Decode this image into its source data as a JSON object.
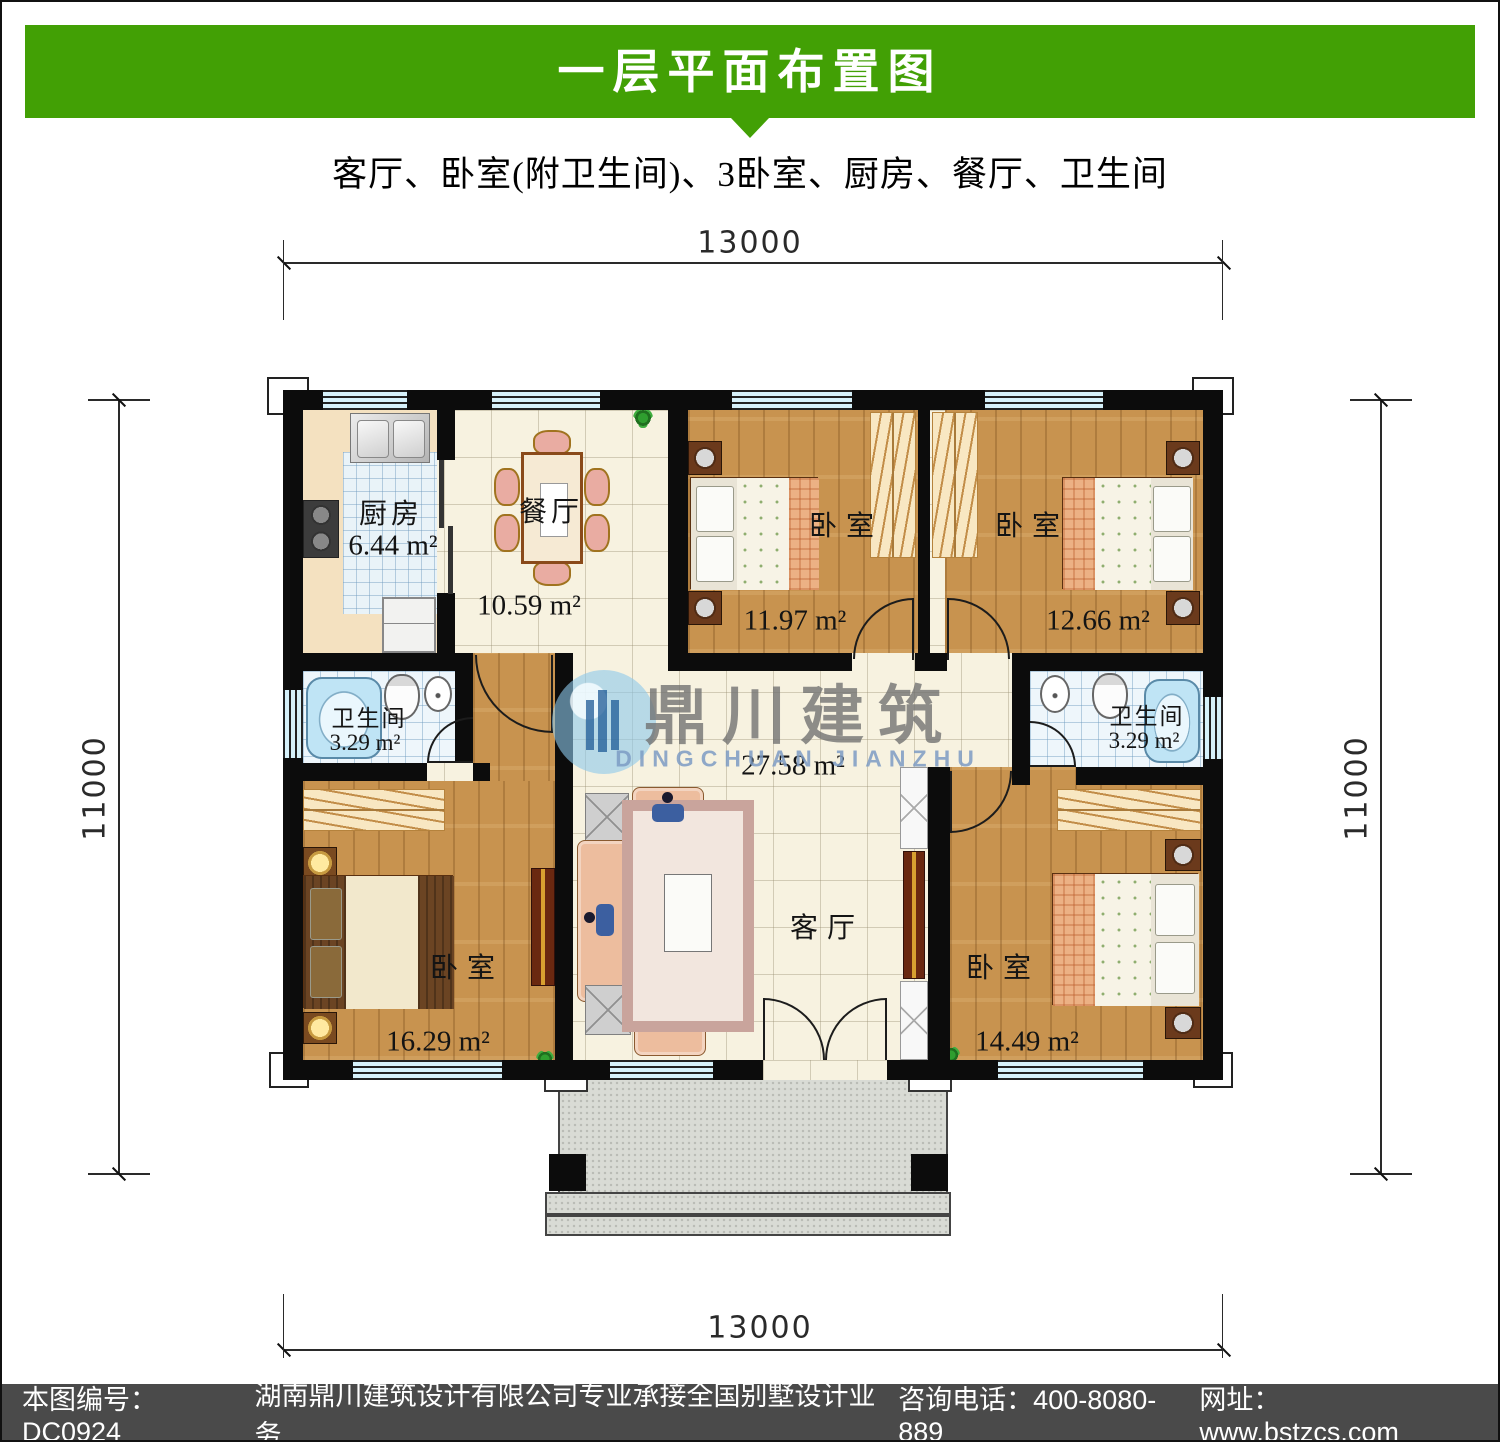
{
  "header": {
    "title": "一层平面布置图",
    "subtitle": "客厅、卧室(附卫生间)、3卧室、厨房、餐厅、卫生间"
  },
  "dimensions": {
    "top": "13000",
    "bottom": "13000",
    "left": "11000",
    "right": "11000"
  },
  "rooms": {
    "kitchen": {
      "name": "厨房",
      "area": "6.44 m²"
    },
    "dining": {
      "name": "餐厅",
      "area": "10.59 m²"
    },
    "bedroom_top_left": {
      "name": "卧室",
      "area": "11.97 m²"
    },
    "bedroom_top_right": {
      "name": "卧室",
      "area": "12.66 m²"
    },
    "bathroom_left": {
      "name": "卫生间",
      "area": "3.29 m²"
    },
    "bathroom_right": {
      "name": "卫生间",
      "area": "3.29 m²"
    },
    "bedroom_bottom_left": {
      "name": "卧室",
      "area": "16.29 m²"
    },
    "bedroom_bottom_right": {
      "name": "卧室",
      "area": "14.49 m²"
    },
    "living": {
      "name": "客厅",
      "area": "27.58 m²"
    }
  },
  "watermark": {
    "cn": "鼎川建筑",
    "en": "DINGCHUAN JIANZHU"
  },
  "footer": {
    "parts": [
      "本图编号：DC0924",
      "湖南鼎川建筑设计有限公司专业承接全国别墅设计业务",
      "咨询电话：400-8080-889",
      "网址：www.bstzcs.com"
    ]
  },
  "colors": {
    "header_green": "#42a005",
    "footer_gray": "#4a4a4a",
    "wall_black": "#0c0c0c",
    "window_blue": "#d6f1fa",
    "wood_floor": "#c8934f",
    "tile_cream": "#f7f2e0"
  }
}
